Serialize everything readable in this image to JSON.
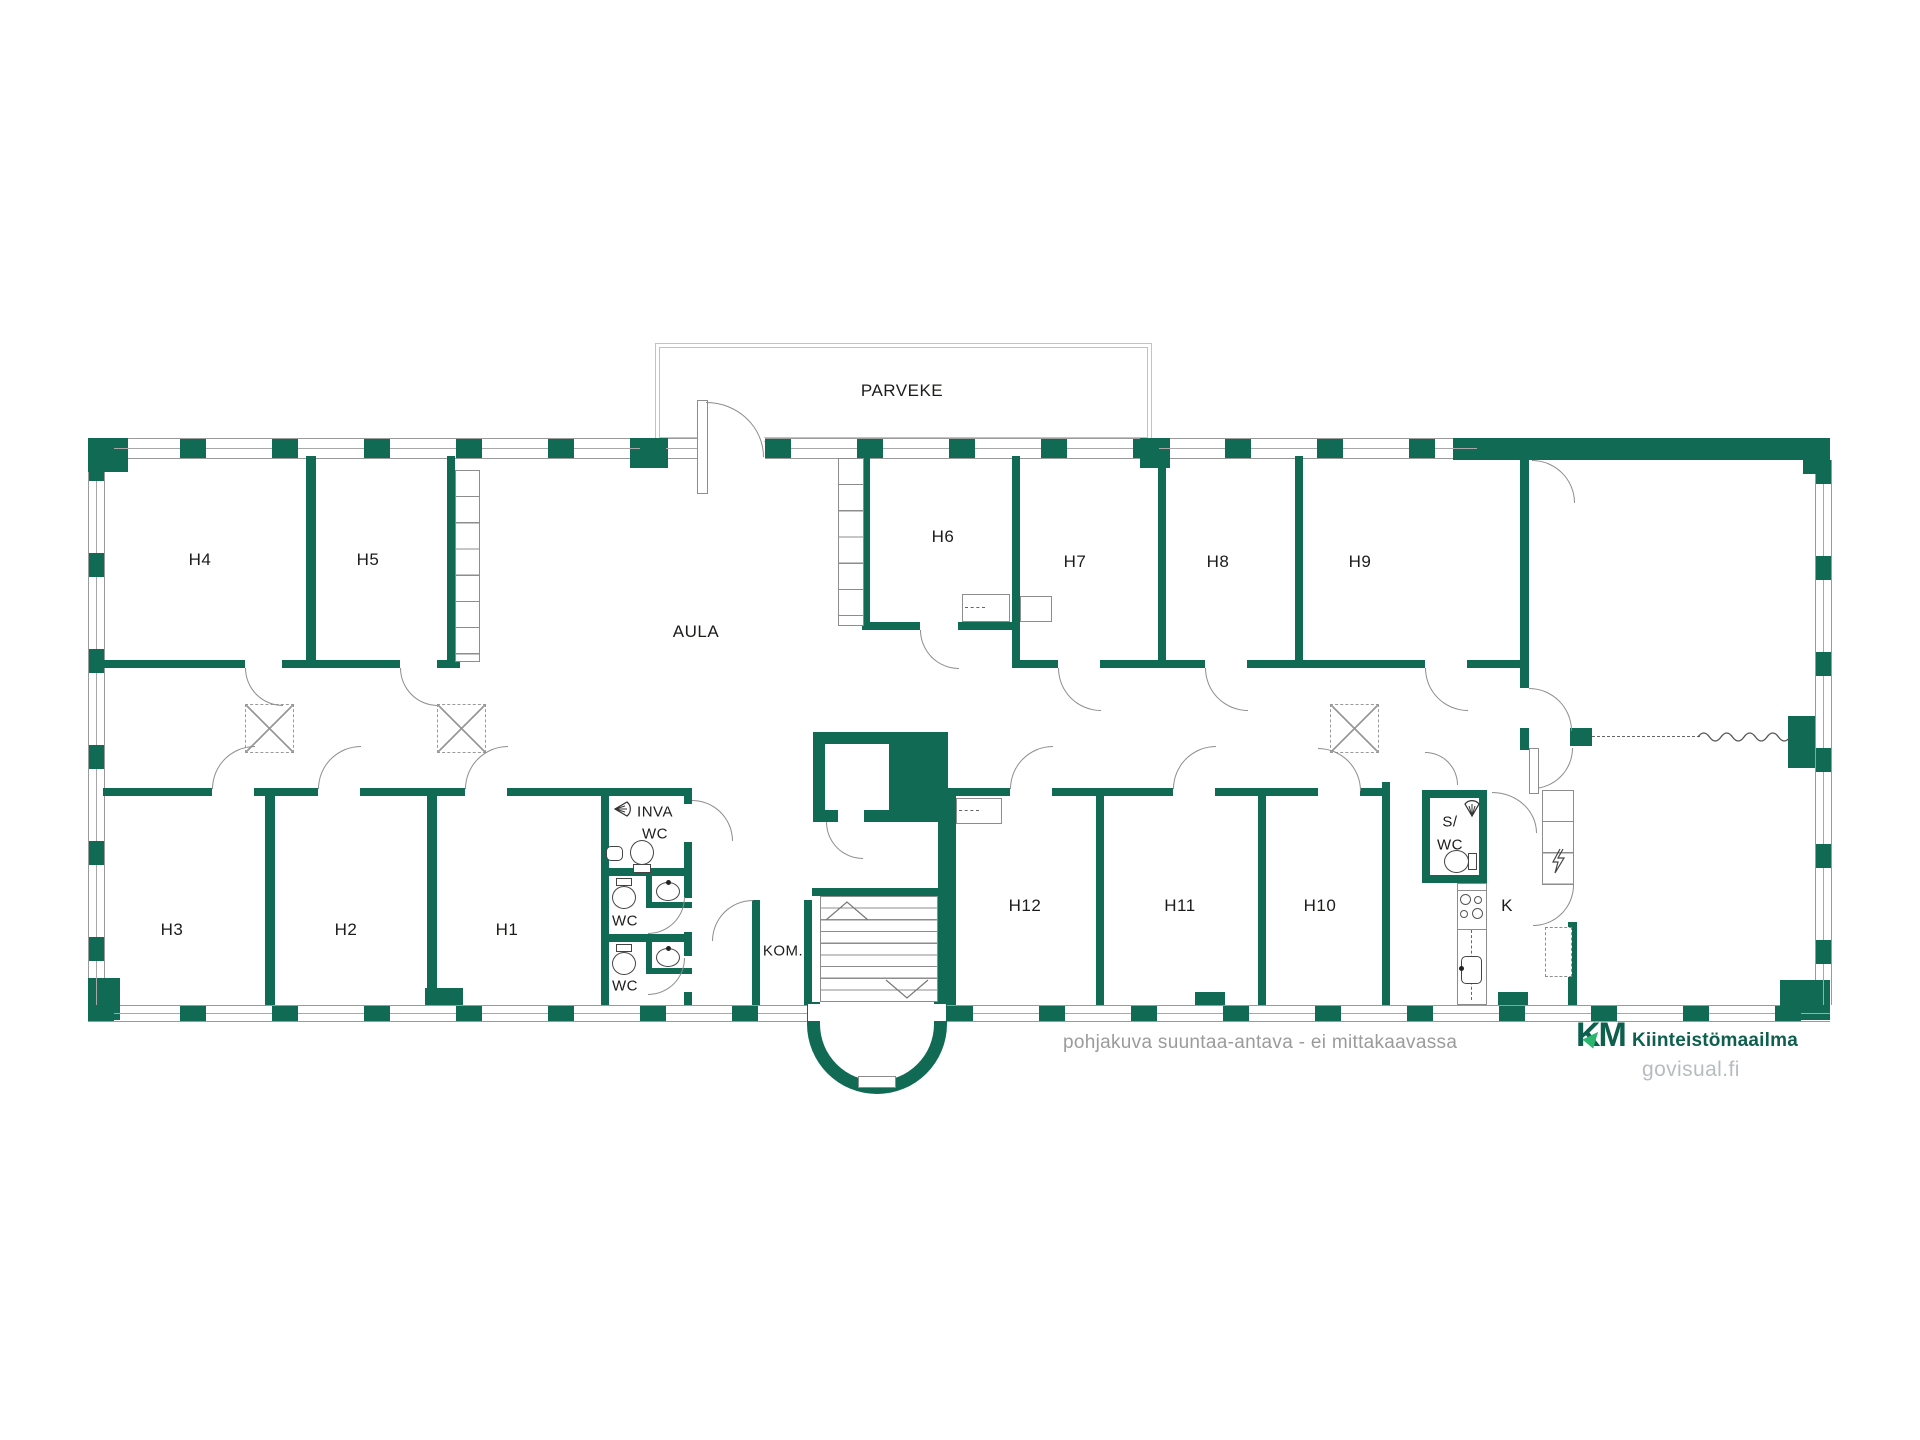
{
  "colors": {
    "wall": "#116a54",
    "outline": "#8d8d8d",
    "balcony_rail": "#a9cec6",
    "text": "#1c1c1b",
    "disclaimer": "#9b9b9b",
    "logo_green_dark": "#0e5f4e",
    "logo_green_accent": "#2cb56e",
    "site_text": "#b7bdbf"
  },
  "labels": {
    "parveke": "PARVEKE",
    "aula": "AULA",
    "h1": "H1",
    "h2": "H2",
    "h3": "H3",
    "h4": "H4",
    "h5": "H5",
    "h6": "H6",
    "h7": "H7",
    "h8": "H8",
    "h9": "H9",
    "h10": "H10",
    "h11": "H11",
    "h12": "H12",
    "hissi": "HISSI",
    "kom": "KOM.",
    "k": "K",
    "inva1": "INVA",
    "inva2": "WC",
    "wc1": "WC",
    "wc2": "WC",
    "swc1": "S/",
    "swc2": "WC"
  },
  "footer": {
    "disclaimer": "pohjakuva suuntaa-antava - ei mittakaavassa",
    "logo_text": "KM",
    "brand": "Kiinteistömaailma",
    "site": "govisual.fi"
  }
}
